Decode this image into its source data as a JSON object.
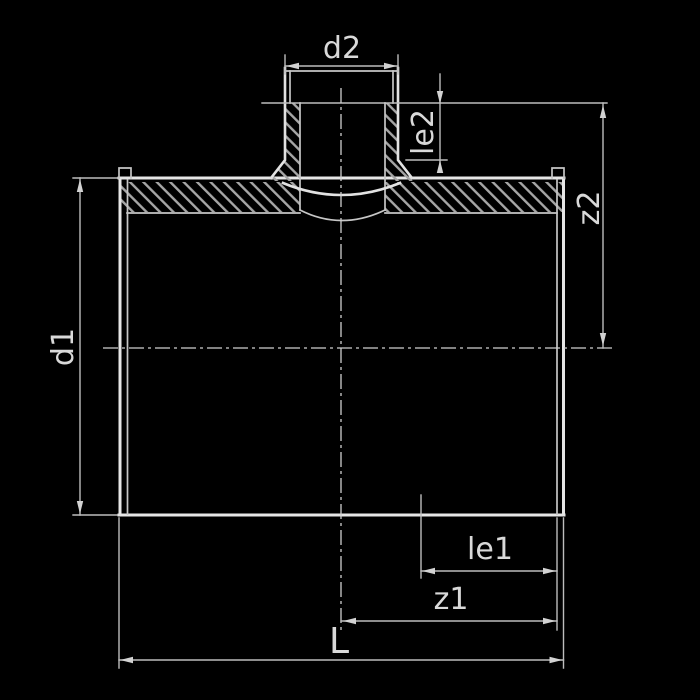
{
  "drawing": {
    "description_labels": {
      "d2": "d2",
      "le2": "le2",
      "z2": "z2",
      "d1": "d1",
      "le1": "le1",
      "z1": "z1",
      "L": "L"
    },
    "colors": {
      "background": "#000000",
      "outline": "#e2e2e2",
      "secondary_line": "#c6c6c6",
      "dimension_line": "#bdbdbd",
      "hatch": "#a6a6a6",
      "text": "#d9d9d9"
    }
  }
}
